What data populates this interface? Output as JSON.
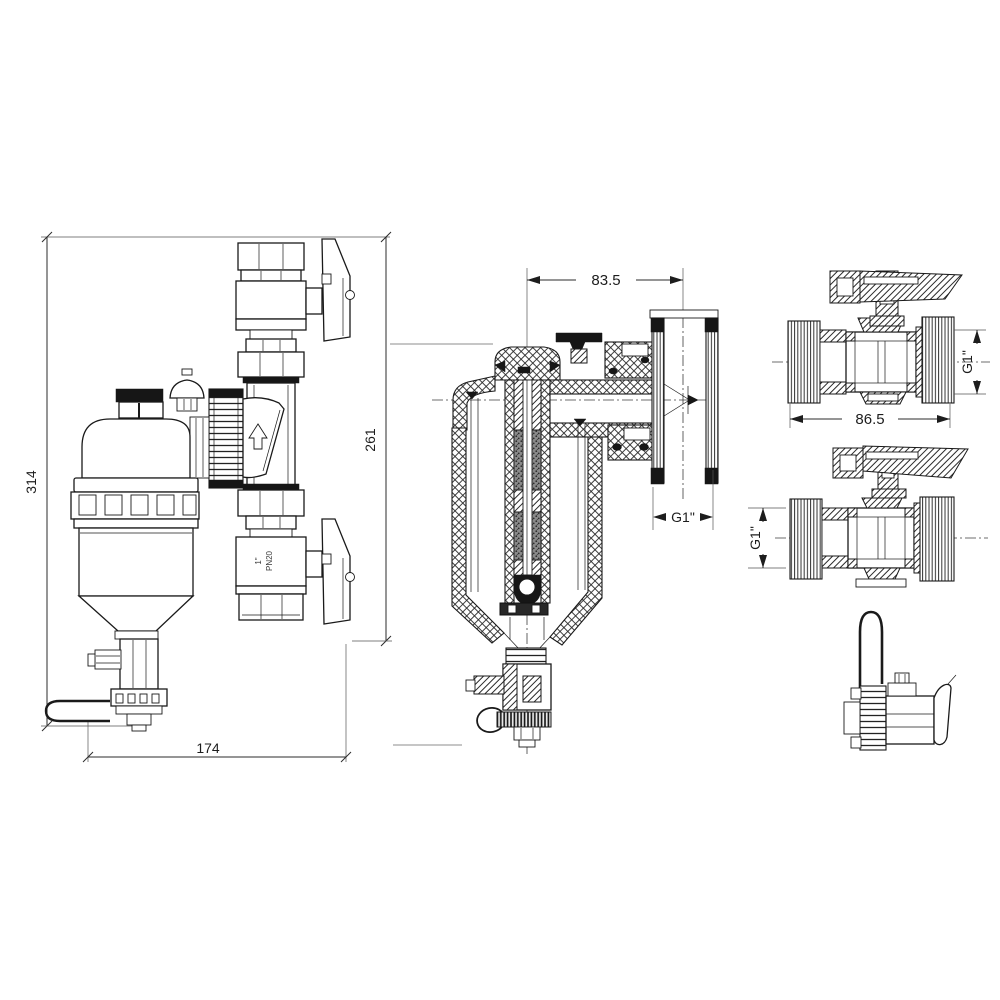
{
  "colors": {
    "background": "#ffffff",
    "line": "#1a1a1a"
  },
  "views": {
    "side": {
      "dim_total_height": "314",
      "dim_right_height": "261",
      "dim_width": "174",
      "valve_marking_pn": "PN20",
      "valve_marking_size": "1\""
    },
    "section": {
      "dim_center_offset": "83.5",
      "dim_port_size": "G1\""
    },
    "valve_top": {
      "dim_length": "86.5",
      "dim_port_size": "G1\""
    },
    "valve_mid": {
      "dim_port_size": "G1\""
    }
  }
}
